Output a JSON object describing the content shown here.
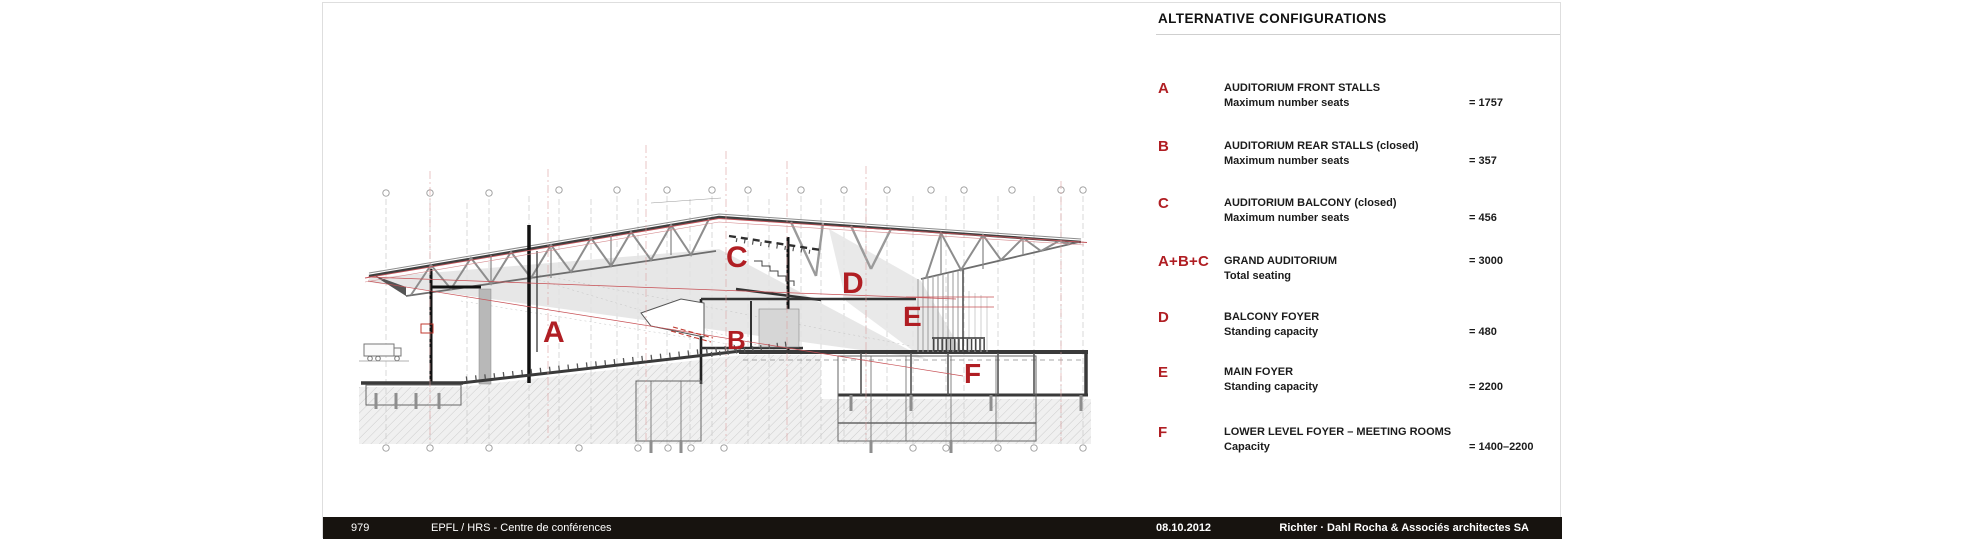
{
  "legend": {
    "title": "ALTERNATIVE CONFIGURATIONS",
    "rows": [
      {
        "letter": "A",
        "title": "AUDITORIUM FRONT STALLS",
        "metric": "Maximum number seats",
        "value": "= 1757"
      },
      {
        "letter": "B",
        "title": "AUDITORIUM REAR STALLS (closed)",
        "metric": "Maximum number seats",
        "value": "= 357"
      },
      {
        "letter": "C",
        "title": "AUDITORIUM BALCONY (closed)",
        "metric": "Maximum number seats",
        "value": "= 456"
      },
      {
        "letter": "A+B+C",
        "title": "GRAND AUDITORIUM",
        "metric": "Total seating",
        "value": "= 3000"
      },
      {
        "letter": "D",
        "title": "BALCONY FOYER",
        "metric": "Standing capacity",
        "value": "= 480"
      },
      {
        "letter": "E",
        "title": "MAIN FOYER",
        "metric": "Standing capacity",
        "value": "= 2200"
      },
      {
        "letter": "F",
        "title": "LOWER LEVEL FOYER – MEETING ROOMS",
        "metric": "Capacity",
        "value": "= 1400–2200"
      }
    ]
  },
  "drawing": {
    "zone_labels": {
      "a": "A",
      "b": "B",
      "c": "C",
      "d": "D",
      "e": "E",
      "f": "F"
    }
  },
  "footer": {
    "page_number": "979",
    "project": "EPFL / HRS - Centre de conférences",
    "date": "08.10.2012",
    "firm": "Richter · Dahl Rocha & Associés architectes SA"
  },
  "colors": {
    "accent_red": "#b01e23",
    "bar_background": "#17130f",
    "line_gray": "#cfcfcf"
  }
}
